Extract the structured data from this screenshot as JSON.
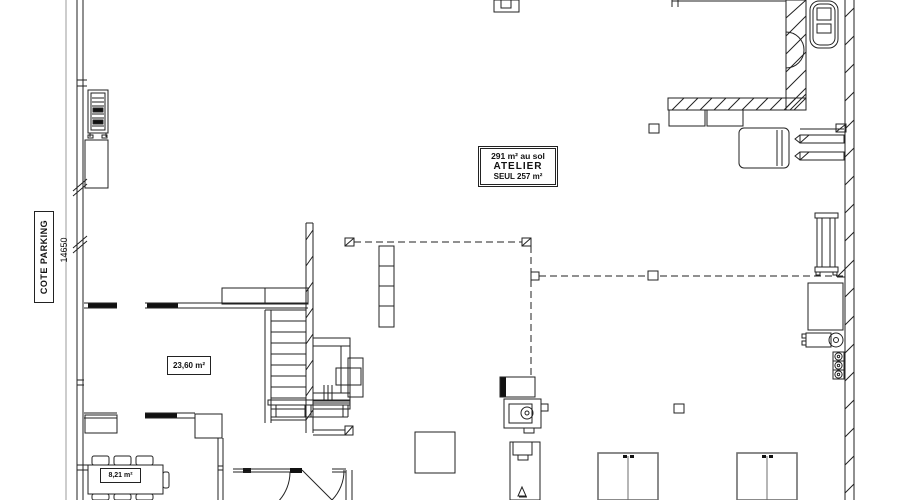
{
  "labels": {
    "side": "COTE PARKING",
    "side_dim": "14650",
    "atelier_area": "291 m² au sol",
    "atelier_name": "ATELIER",
    "atelier_seul": "SEUL 257 m²",
    "room_a": "23,60 m²",
    "room_b": "8,21 m²"
  },
  "colors": {
    "line": "#222222",
    "wall_fill": "#111111",
    "dim_line": "#9b9b9b",
    "cabinet_gray": "#6e6e6e",
    "paper": "#ffffff"
  }
}
